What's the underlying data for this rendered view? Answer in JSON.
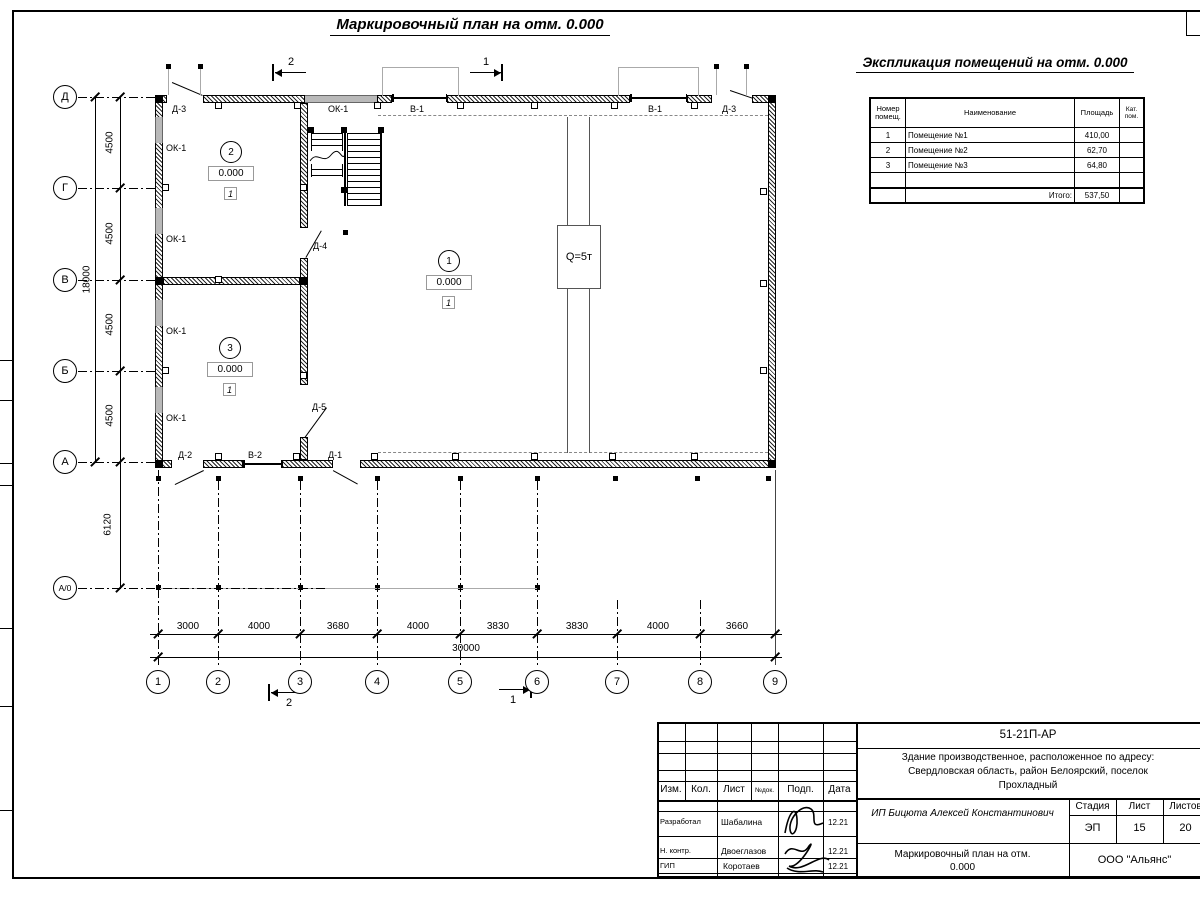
{
  "titles": {
    "plan": "Маркировочный план на отм. 0.000",
    "explication": "Экспликация помещений на отм. 0.000"
  },
  "explication_table": {
    "col_num": "Номер помещ.",
    "col_name": "Наименование",
    "col_area": "Площадь",
    "col_cat": "Кат. пом.",
    "rows": [
      {
        "num": "1",
        "name": "Помещение №1",
        "area": "410,00"
      },
      {
        "num": "2",
        "name": "Помещение №2",
        "area": "62,70"
      },
      {
        "num": "3",
        "name": "Помещение №3",
        "area": "64,80"
      }
    ],
    "total_label": "Итого:",
    "total_area": "537,50"
  },
  "axes": {
    "rows": [
      "Д",
      "Г",
      "В",
      "Б",
      "А",
      "А/0"
    ],
    "cols": [
      "1",
      "2",
      "3",
      "4",
      "5",
      "6",
      "7",
      "8",
      "9"
    ]
  },
  "dims": {
    "v_segments": [
      "4500",
      "4500",
      "4500",
      "4500"
    ],
    "v_total": "18000",
    "v_canopy": "6120",
    "h_segments": [
      "3000",
      "4000",
      "3680",
      "4000",
      "3830",
      "3830",
      "4000",
      "3660"
    ],
    "h_total": "30000"
  },
  "labels": {
    "ok1": "ОК-1",
    "v1": "В-1",
    "v2": "В-2",
    "d1": "Д-1",
    "d2": "Д-2",
    "d3": "Д-3",
    "d4": "Д-4",
    "d5": "Д-5",
    "crane": "Q=5т",
    "sec1": "1",
    "sec2": "2"
  },
  "rooms": [
    {
      "num": "1",
      "elev": "0.000",
      "cat": "1"
    },
    {
      "num": "2",
      "elev": "0.000",
      "cat": "1"
    },
    {
      "num": "3",
      "elev": "0.000",
      "cat": "1"
    }
  ],
  "title_block": {
    "doc_number": "51-21П-АР",
    "project_line1": "Здание производственное, расположенное по адресу:",
    "project_line2": "Свердловская область, район Белоярский, поселок",
    "project_line3": "Прохладный",
    "client": "ИП Бицюта Алексей Константинович",
    "drawing_title_line1": "Маркировочный план на отм.",
    "drawing_title_line2": "0.000",
    "company": "ООО \"Альянс\"",
    "h_izm": "Изм.",
    "h_kol": "Кол.",
    "h_list": "Лист",
    "h_ndok": "№док.",
    "h_podp": "Подп.",
    "h_data": "Дата",
    "h_stage": "Стадия",
    "h_sheet": "Лист",
    "h_sheets": "Листов",
    "stage": "ЭП",
    "sheet": "15",
    "sheets": "20",
    "signers": [
      {
        "role": "Разработал",
        "name": "Шабалина",
        "date": "12.21"
      },
      {
        "role": "Н. контр.",
        "name": "Двоеглазов",
        "date": "12.21"
      },
      {
        "role": "ГИП",
        "name": "Коротаев",
        "date": "12.21"
      }
    ]
  }
}
